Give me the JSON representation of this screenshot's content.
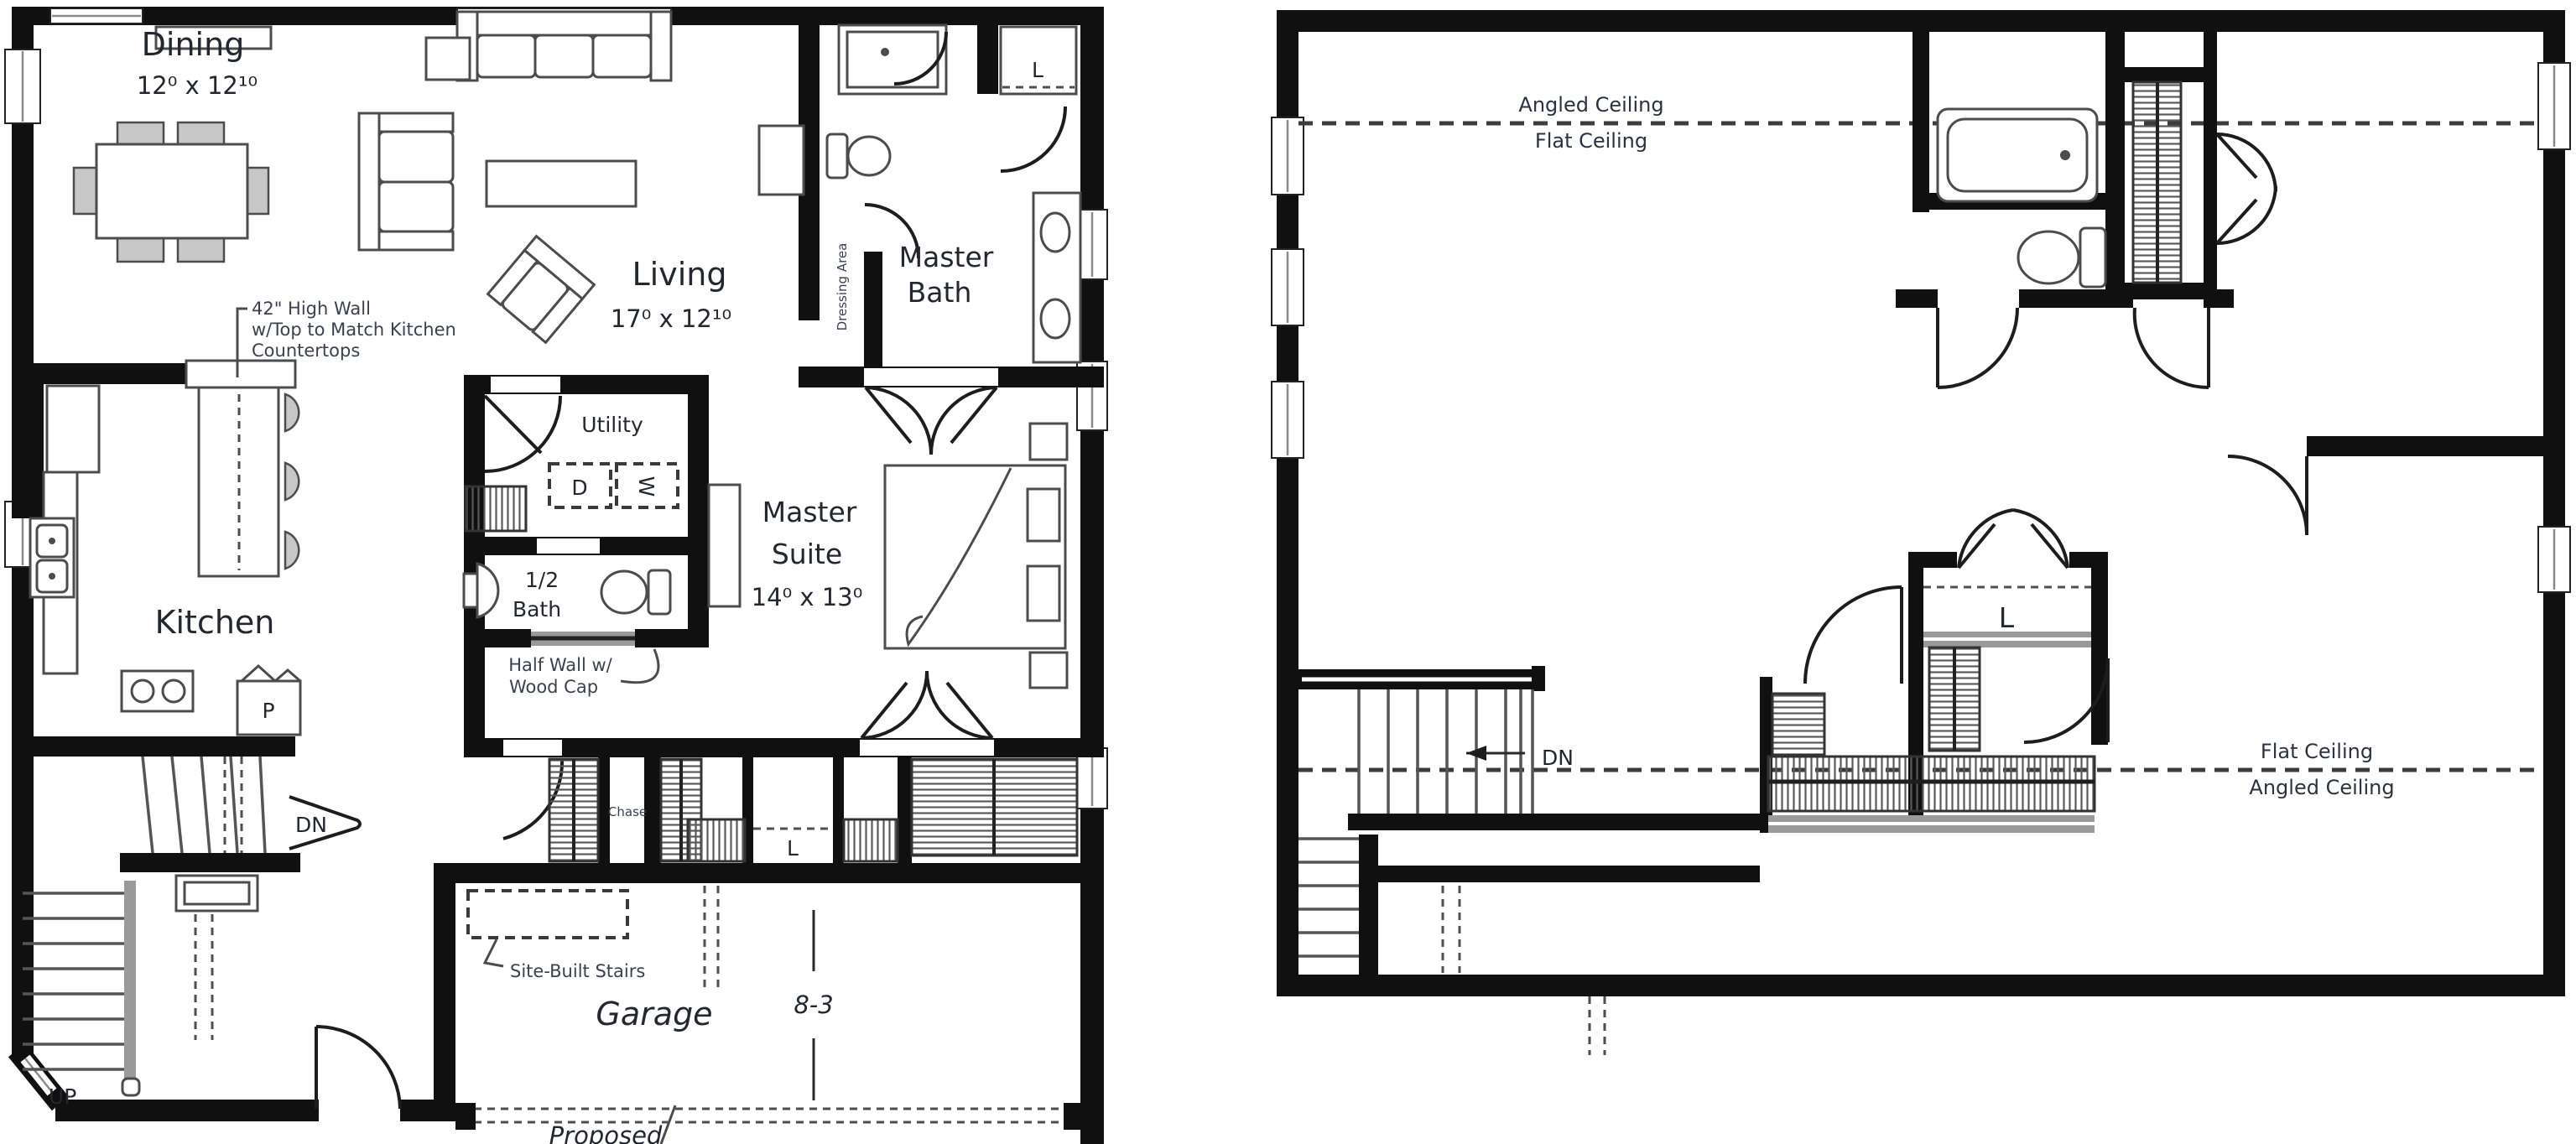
{
  "first_floor": {
    "dining": {
      "name": "Dining",
      "dims": "12⁰ x 12¹⁰"
    },
    "living": {
      "name": "Living",
      "dims": "17⁰ x 12¹⁰"
    },
    "master_bath": {
      "line1": "Master",
      "line2": "Bath"
    },
    "dressing": {
      "label": "Dressing Area"
    },
    "utility": {
      "name": "Utility",
      "dryer": "D",
      "washer": "W"
    },
    "master_suite": {
      "line1": "Master",
      "line2": "Suite",
      "dims": "14⁰ x 13⁰"
    },
    "half_bath": {
      "line1": "1/2",
      "line2": "Bath"
    },
    "kitchen": {
      "name": "Kitchen",
      "pantry": "P"
    },
    "closets": {
      "chase": "Chase",
      "linen": "L",
      "bath_linen": "L"
    },
    "stairs": {
      "down": "DN",
      "up": "UP"
    },
    "garage": {
      "name": "Garage",
      "dim": "8-3",
      "proposed": "Proposed"
    },
    "notes": {
      "high_wall_line1": "42\" High Wall",
      "high_wall_line2": "w/Top to Match Kitchen",
      "high_wall_line3": "Countertops",
      "half_wall_line1": "Half Wall w/",
      "half_wall_line2": "Wood Cap",
      "site_stairs": "Site-Built Stairs"
    }
  },
  "second_floor": {
    "ceiling_top": {
      "above": "Angled Ceiling",
      "below": "Flat Ceiling"
    },
    "ceiling_bottom": {
      "above": "Flat Ceiling",
      "below": "Angled Ceiling"
    },
    "stairs": {
      "down": "DN"
    },
    "closets": {
      "linen": "L"
    }
  }
}
